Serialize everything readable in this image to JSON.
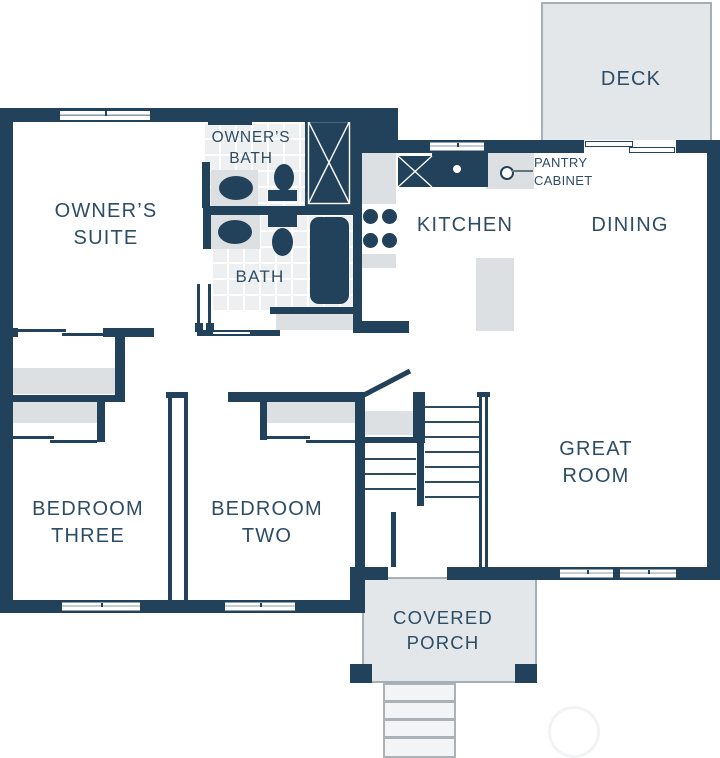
{
  "colors": {
    "wall": "#22415a",
    "label_text": "#2d4c66",
    "area_fill": "#e4e7ea",
    "area_border": "#a7afb6",
    "counter_fill": "#dde0e3",
    "tile_fill": "#edeff0",
    "grout": "#ffffff",
    "stair_tread": "#2e4a60"
  },
  "rooms": {
    "deck": {
      "label": "DECK"
    },
    "kitchen": {
      "label": "KITCHEN"
    },
    "dining": {
      "label": "DINING"
    },
    "great_room": {
      "label": "GREAT\nROOM"
    },
    "owners_suite": {
      "label": "OWNER’S\nSUITE"
    },
    "owners_bath": {
      "label": "OWNER’S\nBATH"
    },
    "bath": {
      "label": "BATH"
    },
    "bedroom_three": {
      "label": "BEDROOM\nTHREE"
    },
    "bedroom_two": {
      "label": "BEDROOM\nTWO"
    },
    "covered_porch": {
      "label": "COVERED\nPORCH"
    }
  },
  "callouts": {
    "pantry_cabinet": {
      "label": "PANTRY\nCABINET"
    }
  },
  "fixtures": {
    "owners_bath": [
      "shower",
      "vanity-sink",
      "toilet"
    ],
    "bath": [
      "vanity-sink",
      "toilet",
      "bathtub"
    ],
    "kitchen": [
      "refrigerator",
      "kitchen-sink",
      "range-burners",
      "island",
      "pantry-cabinet-counter"
    ],
    "stairs": [
      "upper-flight-treads",
      "lower-flight-treads",
      "landing",
      "door-swing"
    ],
    "covered_porch": [
      "entry-steps",
      "porch-posts"
    ]
  }
}
